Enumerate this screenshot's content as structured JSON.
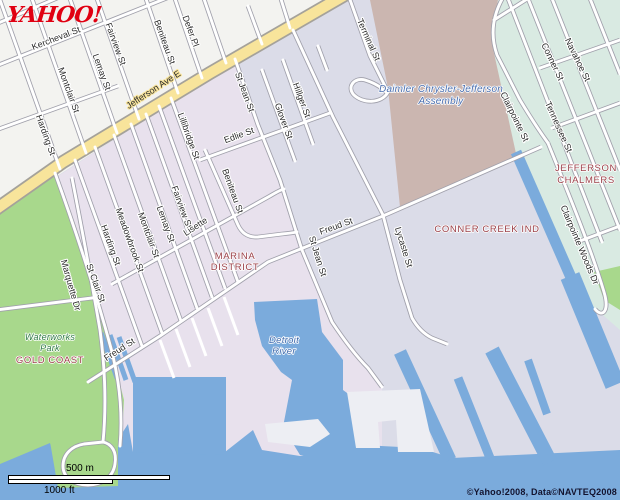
{
  "branding": {
    "logo_text": "YAHOO!",
    "logo_color": "#e00011"
  },
  "attribution": {
    "copyright": "©Yahoo!2008, Data©NAVTEQ2008"
  },
  "scale_bar": {
    "metric_label": "500 m",
    "imperial_label": "1000 ft"
  },
  "map": {
    "colors": {
      "industrial": "#dbdce8",
      "residential_nw": "#f3f3f0",
      "residential_pink": "#e8e1ed",
      "park": "#a8d88c",
      "factory": "#cbb6b0",
      "teal_area": "#d9eae2",
      "water": "#7babdc",
      "dock": "#edeef3",
      "road_casing": "#a0a0ab",
      "major_road": "#f8e49b",
      "major_road_casing": "#a5a29a"
    },
    "areas": [
      {
        "id": "residential-northwest",
        "color": "residential_nw",
        "d": "M0,0 L348,0 L212,76 L0,213 Z"
      },
      {
        "id": "marina-district-pink",
        "color": "residential_pink",
        "d": "M0,214 L212,76 L235,59 L258,125 L280,180 L302,250 L332,322 L360,360 L382,388 L382,500 L0,500 Z"
      },
      {
        "id": "waterworks-park",
        "color": "park",
        "d": "M0,212 L55,173 L90,270 L112,352 L124,400 L120,470 L0,470 Z"
      },
      {
        "id": "chrysler-plant",
        "color": "factory",
        "d": "M370,0 L498,0 L492,42 L522,118 L542,146 L400,207 L388,88 Z"
      },
      {
        "id": "jefferson-chalmers-area",
        "color": "teal_area",
        "d": "M498,0 L620,0 L620,330 L588,302 L517,158 L492,44 Z"
      }
    ],
    "water": [
      {
        "kind": "poly",
        "d": "M0,464 L50,443 L56,460 L110,452 L128,424 L133,452 L225,452 L253,430 L262,450 L300,456 L343,444 L420,448 L452,458 L620,450 L620,500 L0,500 Z"
      },
      {
        "kind": "poly",
        "d": "M133,377 L226,377 L226,455 L133,452 Z"
      },
      {
        "kind": "poly",
        "d": "M254,302 L317,299 L322,332 L343,360 L343,390 L362,404 L370,438 L352,455 L300,455 L283,427 L292,380 L281,372 L262,346 L255,320 Z"
      },
      {
        "kind": "line",
        "w": 13,
        "d": "M400,352 L450,460"
      },
      {
        "kind": "line",
        "w": 9,
        "d": "M458,378 L490,458"
      },
      {
        "kind": "line",
        "w": 15,
        "d": "M492,350 L550,462"
      },
      {
        "kind": "line",
        "w": 11,
        "d": "M516,152 L573,282"
      },
      {
        "kind": "line",
        "w": 20,
        "d": "M570,276 L615,385"
      },
      {
        "kind": "line",
        "w": 8,
        "d": "M528,360 L547,414"
      },
      {
        "kind": "line",
        "w": 5,
        "d": "M101,333 L117,378"
      },
      {
        "kind": "line",
        "w": 5,
        "d": "M110,335 L126,380"
      },
      {
        "kind": "line",
        "w": 5,
        "d": "M119,337 L135,382"
      }
    ],
    "green_overlays": [
      {
        "d": "M48,430 L118,428 L118,486 L58,488 Z"
      },
      {
        "d": "M594,272 L620,266 L620,310 L604,300 Z"
      }
    ],
    "docks": [
      {
        "d": "M265,424 L318,419 L330,434 L310,447 L268,442 Z"
      },
      {
        "d": "M347,392 L420,389 L434,452 L398,452 L396,420 L378,422 L380,448 L356,448 Z"
      }
    ],
    "dock_lines": [
      "M160,340 L174,378",
      "M176,329 L190,367",
      "M192,318 L206,356",
      "M208,308 L222,346",
      "M224,297 L238,335"
    ],
    "roads": [
      {
        "id": "jefferson-ave-e",
        "kind": "major",
        "d": "M350,-8 L210,73 L63,162 L-8,212"
      },
      {
        "id": "kercheval-st",
        "kind": "street",
        "d": "M-4,66 L172,-4"
      },
      {
        "id": "top-cross",
        "kind": "street",
        "d": "M-4,24 L62,-4"
      },
      {
        "id": "mid-cross",
        "kind": "street",
        "d": "M-4,130 L118,86"
      },
      {
        "id": "harding-st-n",
        "kind": "street",
        "d": "M0,0 L60,169"
      },
      {
        "id": "montclair-st-n",
        "kind": "street",
        "d": "M31,-4 L86,153"
      },
      {
        "id": "lemay-st-n",
        "kind": "street",
        "d": "M69,-4 L117,133"
      },
      {
        "id": "fairview-st-n",
        "kind": "street",
        "d": "M96,-4 L139,119"
      },
      {
        "id": "beniteau-st-n",
        "kind": "street",
        "d": "M145,-4 L178,93"
      },
      {
        "id": "defer-pl",
        "kind": "street",
        "d": "M174,-4 L202,78"
      },
      {
        "id": "side-ne",
        "kind": "street",
        "d": "M203,-4 L226,63"
      },
      {
        "id": "stub-n1",
        "kind": "street",
        "d": "M248,6 L262,44"
      },
      {
        "id": "stub-n2",
        "kind": "street",
        "d": "M280,-4 L290,28"
      },
      {
        "id": "stub-s1",
        "kind": "street",
        "d": "M318,46 L327,70"
      },
      {
        "id": "marquette-dr",
        "kind": "street",
        "d": "M55,173 Q90,270 112,352 Q124,400 120,446"
      },
      {
        "id": "st-clair-st",
        "kind": "street",
        "d": "M75,160 L142,346"
      },
      {
        "id": "harding-st-s",
        "kind": "street",
        "d": "M95,147 L162,333"
      },
      {
        "id": "meadowbrook-st",
        "kind": "street",
        "d": "M114,135 L181,321"
      },
      {
        "id": "montclair-st-s",
        "kind": "street",
        "d": "M131,124 L197,308"
      },
      {
        "id": "lemay-st-s",
        "kind": "street",
        "d": "M146,114 L212,297"
      },
      {
        "id": "fairview-st-s",
        "kind": "street",
        "d": "M159,106 L225,288"
      },
      {
        "id": "lillibridge-st",
        "kind": "street",
        "d": "M171,98 L238,282"
      },
      {
        "id": "lisette",
        "kind": "street",
        "d": "M112,284 L270,196 Q280,190 284,189"
      },
      {
        "id": "beniteau-st-s",
        "kind": "street",
        "d": "M205,150 L238,225 Q244,238 258,237 L282,234 Q292,233 297,232"
      },
      {
        "id": "edlie-st",
        "kind": "street",
        "d": "M200,160 L330,113"
      },
      {
        "id": "glover-st",
        "kind": "street",
        "d": "M262,70 L295,161"
      },
      {
        "id": "hillger-st",
        "kind": "street",
        "d": "M283,60 L313,144"
      },
      {
        "id": "st-jean-st",
        "kind": "street",
        "d": "M235,59 L258,125 L280,180 L302,250 L332,322 Q352,352 368,368 L382,387"
      },
      {
        "id": "terminal-st",
        "kind": "street",
        "d": "M348,-6 L370,56 L388,92"
      },
      {
        "id": "terminal-loop",
        "kind": "street",
        "d": "M388,92 C382,104 362,104 353,94 C347,86 355,77 365,80 C375,83 382,88 386,92"
      },
      {
        "id": "connector-ne",
        "kind": "street",
        "d": "M293,30 L333,117 L383,215"
      },
      {
        "id": "lycaste-st",
        "kind": "street",
        "d": "M383,215 L400,280 L412,318 Q420,332 432,338 L447,344"
      },
      {
        "id": "freud-st",
        "kind": "street",
        "d": "M88,382 L160,336 L268,262 L383,216 L541,147"
      },
      {
        "id": "clairpointe-st",
        "kind": "street",
        "d": "M505,-6 C492,15 490,35 497,55 L520,100 Q535,125 548,143"
      },
      {
        "id": "clairpointe-woods-dr",
        "kind": "street",
        "d": "M548,143 C565,185 590,245 604,292 C610,312 602,318 595,309"
      },
      {
        "id": "tennessee-st",
        "kind": "street",
        "d": "M507,-4 L602,242"
      },
      {
        "id": "conner-st",
        "kind": "street",
        "d": "M527,-4 L620,230"
      },
      {
        "id": "navahoe-st",
        "kind": "street",
        "d": "M551,-4 L620,170"
      },
      {
        "id": "edge-ne-st",
        "kind": "street",
        "d": "M589,-4 L620,74"
      },
      {
        "id": "teal-cross-0",
        "kind": "street",
        "d": "M494,20 L532,-4"
      },
      {
        "id": "teal-cross-1",
        "kind": "street",
        "d": "M540,68 L620,40"
      },
      {
        "id": "teal-cross-2",
        "kind": "street",
        "d": "M552,128 L620,103"
      },
      {
        "id": "teal-cross-3",
        "kind": "street",
        "d": "M580,241 L620,226"
      },
      {
        "id": "park-center-rd",
        "kind": "street",
        "d": "M72,178 Q88,260 100,330 Q108,390 103,442"
      },
      {
        "id": "park-cross-rd",
        "kind": "street",
        "d": "M-4,310 L100,297"
      },
      {
        "id": "park-loop-rd",
        "kind": "street",
        "d": "M103,442 C112,444 117,452 115,464 C113,478 101,485 88,485 C74,485 63,478 63,466 C63,454 72,446 84,444 Z"
      }
    ],
    "road_labels": [
      {
        "text": "Kercheval St",
        "x": 57,
        "y": 41,
        "rot": -21
      },
      {
        "text": "Fairview St",
        "x": 113,
        "y": 45,
        "rot": 70
      },
      {
        "text": "Beniteau St",
        "x": 162,
        "y": 43,
        "rot": 70
      },
      {
        "text": "Defer Pl",
        "x": 188,
        "y": 32,
        "rot": 70
      },
      {
        "text": "Lemay St",
        "x": 99,
        "y": 73,
        "rot": 70
      },
      {
        "text": "Montclair St",
        "x": 66,
        "y": 91,
        "rot": 70
      },
      {
        "text": "Harding St",
        "x": 43,
        "y": 136,
        "rot": 70
      },
      {
        "text": "Jefferson Ave E",
        "x": 155,
        "y": 92,
        "rot": -33,
        "cls": "on-major"
      },
      {
        "text": "Lillibridge St",
        "x": 186,
        "y": 137,
        "rot": 70
      },
      {
        "text": "Fairview St",
        "x": 179,
        "y": 208,
        "rot": 70
      },
      {
        "text": "Lemay St",
        "x": 163,
        "y": 225,
        "rot": 70
      },
      {
        "text": "Montclair St",
        "x": 146,
        "y": 236,
        "rot": 70
      },
      {
        "text": "Meadowbrook St",
        "x": 127,
        "y": 241,
        "rot": 70
      },
      {
        "text": "Harding St",
        "x": 108,
        "y": 246,
        "rot": 70
      },
      {
        "text": "St Clair St",
        "x": 93,
        "y": 284,
        "rot": 70
      },
      {
        "text": "Marquette Dr",
        "x": 68,
        "y": 286,
        "rot": 74
      },
      {
        "text": "Lisette",
        "x": 197,
        "y": 229,
        "rot": -33
      },
      {
        "text": "Freud St",
        "x": 121,
        "y": 352,
        "rot": -33
      },
      {
        "text": "Freud St",
        "x": 337,
        "y": 229,
        "rot": -20
      },
      {
        "text": "St Jean St",
        "x": 242,
        "y": 93,
        "rot": 70
      },
      {
        "text": "St Jean St",
        "x": 315,
        "y": 257,
        "rot": 73
      },
      {
        "text": "Edlie St",
        "x": 240,
        "y": 138,
        "rot": -20
      },
      {
        "text": "Beniteau St",
        "x": 230,
        "y": 192,
        "rot": 70
      },
      {
        "text": "Glover St",
        "x": 281,
        "y": 122,
        "rot": 70
      },
      {
        "text": "Hillger St",
        "x": 299,
        "y": 101,
        "rot": 70
      },
      {
        "text": "Terminal St",
        "x": 366,
        "y": 41,
        "rot": 66
      },
      {
        "text": "Lycaste St",
        "x": 401,
        "y": 248,
        "rot": 73
      },
      {
        "text": "Clairpointe St",
        "x": 512,
        "y": 118,
        "rot": 64
      },
      {
        "text": "Tennessee St",
        "x": 556,
        "y": 128,
        "rot": 66
      },
      {
        "text": "Conner St",
        "x": 550,
        "y": 63,
        "rot": 64
      },
      {
        "text": "Navahoe St",
        "x": 575,
        "y": 61,
        "rot": 64
      },
      {
        "text": "Clairpointe Woods Dr",
        "x": 577,
        "y": 246,
        "rot": 67
      }
    ],
    "area_labels": [
      {
        "text": "MARINA",
        "x": 235,
        "y": 259,
        "cls": "district"
      },
      {
        "text": "DISTRICT",
        "x": 235,
        "y": 270,
        "cls": "district"
      },
      {
        "text": "CONNER CREEK IND",
        "x": 487,
        "y": 232,
        "cls": "district"
      },
      {
        "text": "JEFFERSON",
        "x": 586,
        "y": 171,
        "cls": "district"
      },
      {
        "text": "CHALMERS",
        "x": 586,
        "y": 183,
        "cls": "district"
      },
      {
        "text": "GOLD COAST",
        "x": 50,
        "y": 363,
        "cls": "district"
      },
      {
        "text": "Waterworks",
        "x": 50,
        "y": 340,
        "cls": "park"
      },
      {
        "text": "Park",
        "x": 50,
        "y": 351,
        "cls": "park"
      },
      {
        "text": "Daimler Chrysler-Jefferson",
        "x": 441,
        "y": 92,
        "cls": "poi"
      },
      {
        "text": "Assembly",
        "x": 441,
        "y": 104,
        "cls": "poi"
      },
      {
        "text": "Detroit",
        "x": 284,
        "y": 343,
        "cls": "waterlbl"
      },
      {
        "text": "River",
        "x": 284,
        "y": 354,
        "cls": "waterlbl"
      }
    ]
  }
}
